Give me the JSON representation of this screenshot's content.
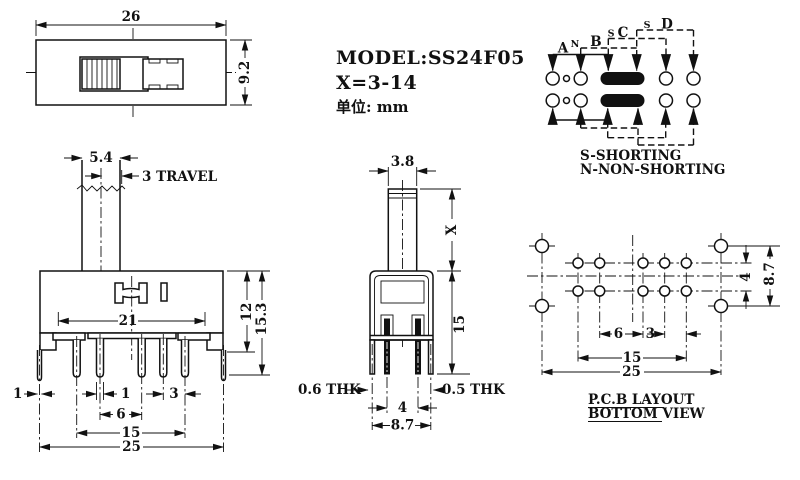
{
  "colors": {
    "line": "#111111",
    "background": "#ffffff",
    "contact_fill": "#111111"
  },
  "title_block": {
    "model": "MODEL:SS24F05",
    "shaft_range": "X=3-14",
    "unit_label": "单位: mm"
  },
  "top_view": {
    "dim_width": "26",
    "dim_height": "9.2"
  },
  "schematic": {
    "pos_a": "A",
    "pos_n": "N",
    "pos_b": "B",
    "pos_s1": "S",
    "pos_c": "C",
    "pos_s2": "S",
    "pos_d": "D",
    "legend_shorting": "S-SHORTING",
    "legend_non_shorting": "N-NON-SHORTING"
  },
  "front_view": {
    "dim_knob_width": "5.4",
    "dim_travel": "3 TRAVEL",
    "dim_frame_width": "21",
    "dim_body_height": "12",
    "dim_total_height": "15.3",
    "dim_bracket_thk": "1",
    "dim_pin_width": "1",
    "dim_pin_gap": "3",
    "dim_pin_pitch": "6",
    "dim_pin_span": "15",
    "dim_bracket_span": "25"
  },
  "side_view": {
    "dim_stem_width": "3.8",
    "dim_stem_height": "X",
    "dim_body_height": "15",
    "dim_thk_left": "0.6 THK",
    "dim_thk_right": "0.5 THK",
    "dim_pin_gap": "4",
    "dim_body_width": "8.7"
  },
  "pcb_view": {
    "dim_pitch6": "6",
    "dim_pitch3": "3",
    "dim_span15": "15",
    "dim_span25": "25",
    "dim_row_gap": "4",
    "dim_mount_gap": "8.7",
    "caption_line1": "P.C.B LAYOUT",
    "caption_line2": "BOTTOM VIEW"
  }
}
